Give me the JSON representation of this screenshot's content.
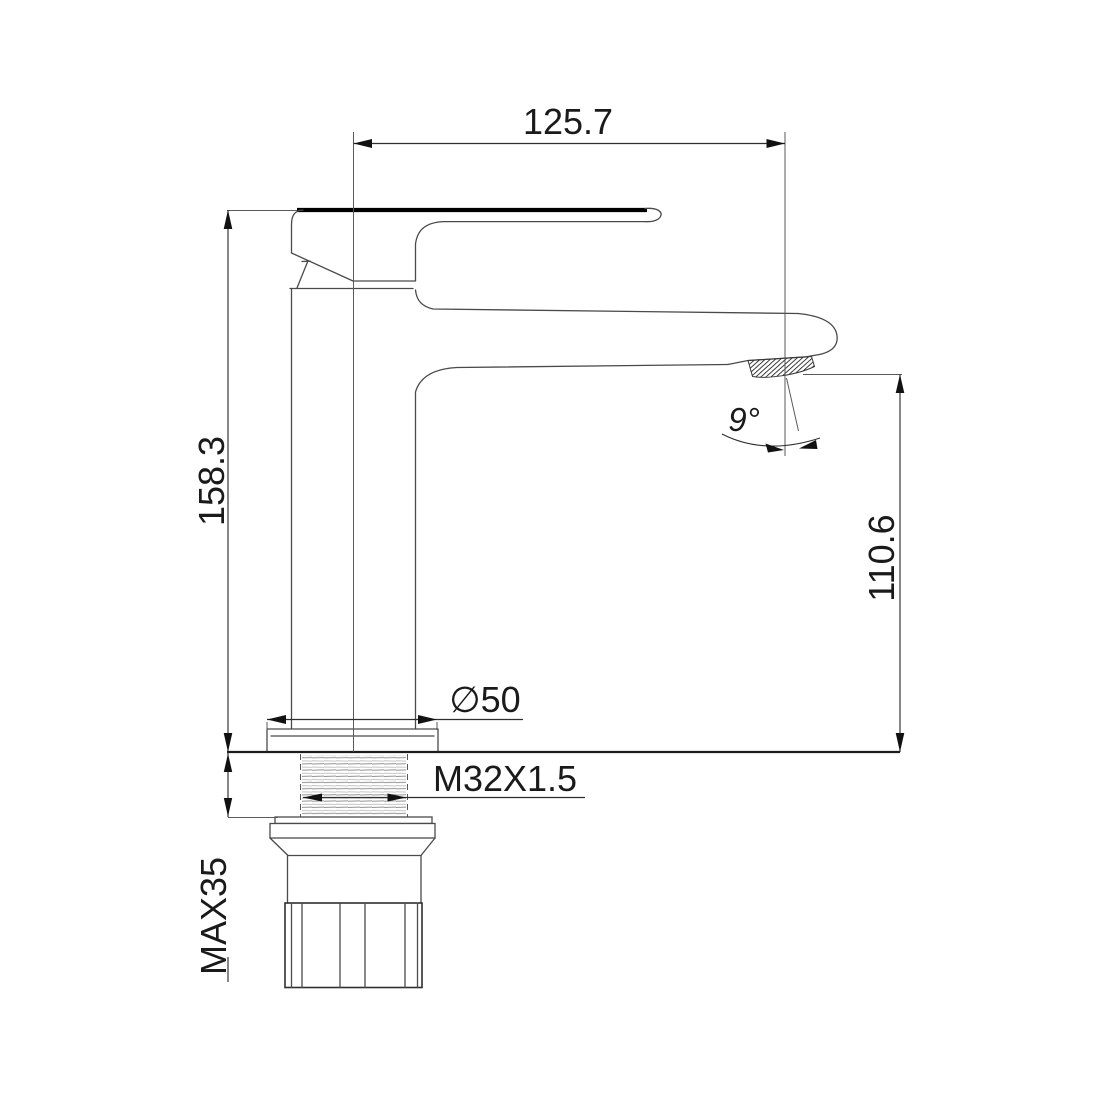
{
  "background": "#ffffff",
  "line_color": "#4a4a4a",
  "dimension_color": "#1a1a1a",
  "drawing": {
    "subject": "single-lever basin faucet side elevation",
    "dimensions": {
      "spout_reach": {
        "label": "125.7",
        "value": 125.7
      },
      "total_height": {
        "label": "158.3",
        "value": 158.3
      },
      "outlet_height": {
        "label": "110.6",
        "value": 110.6
      },
      "outlet_angle": {
        "label": "9°",
        "value": 9
      },
      "base_diameter": {
        "label": "∅50",
        "value": 50
      },
      "thread": {
        "label": "M32X1.5"
      },
      "max_deck": {
        "label": "MAX35",
        "value": 35
      }
    }
  }
}
